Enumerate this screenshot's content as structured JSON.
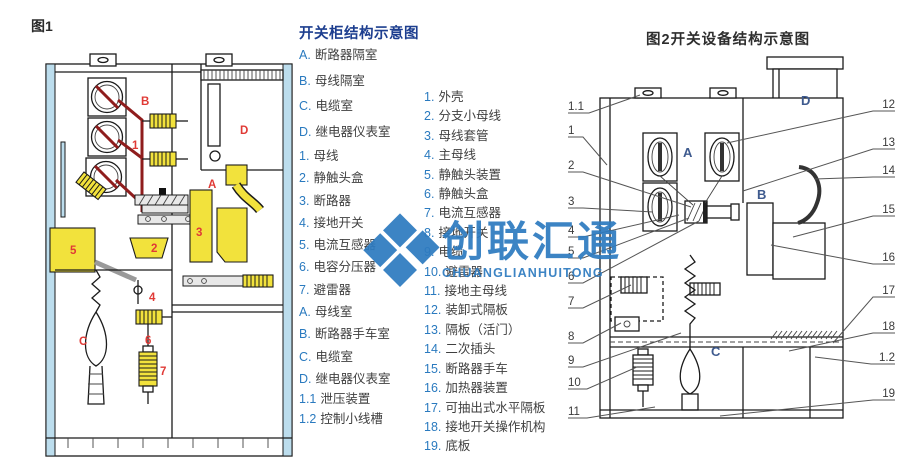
{
  "figure1": {
    "caption": "图1",
    "labels": [
      "B",
      "1",
      "D",
      "A",
      "5",
      "2",
      "3",
      "4",
      "C",
      "6",
      "7"
    ]
  },
  "center_legend": {
    "title": "开关柜结构示意图",
    "rooms1": [
      {
        "key": "A.",
        "label": "断路器隔室"
      },
      {
        "key": "B.",
        "label": "母线隔室"
      },
      {
        "key": "C.",
        "label": "电缆室"
      },
      {
        "key": "D.",
        "label": "继电器仪表室"
      }
    ],
    "parts": [
      {
        "key": "1.",
        "label": "母线"
      },
      {
        "key": "2.",
        "label": "静触头盒"
      },
      {
        "key": "3.",
        "label": "断路器"
      },
      {
        "key": "4.",
        "label": "接地开关"
      },
      {
        "key": "5.",
        "label": "电流互感器"
      },
      {
        "key": "6.",
        "label": "电容分压器"
      },
      {
        "key": "7.",
        "label": "避雷器"
      }
    ],
    "rooms2": [
      {
        "key": "A.",
        "label": "母线室"
      },
      {
        "key": "B.",
        "label": "断路器手车室"
      },
      {
        "key": "C.",
        "label": "电缆室"
      },
      {
        "key": "D.",
        "label": "继电器仪表室"
      }
    ],
    "extra": [
      {
        "key": "1.1",
        "label": "泄压装置"
      },
      {
        "key": "1.2",
        "label": "控制小线槽"
      }
    ]
  },
  "right_legend": {
    "items": [
      {
        "key": "1.",
        "label": "外壳"
      },
      {
        "key": "2.",
        "label": "分支小母线"
      },
      {
        "key": "3.",
        "label": "母线套管"
      },
      {
        "key": "4.",
        "label": "主母线"
      },
      {
        "key": "5.",
        "label": "静触头装置"
      },
      {
        "key": "6.",
        "label": "静触头盒"
      },
      {
        "key": "7.",
        "label": "电流互感器"
      },
      {
        "key": "8.",
        "label": "接地开关"
      },
      {
        "key": "9.",
        "label": "电缆"
      },
      {
        "key": "10.",
        "label": "避雷器"
      },
      {
        "key": "11.",
        "label": "接地主母线"
      },
      {
        "key": "12.",
        "label": "装卸式隔板"
      },
      {
        "key": "13.",
        "label": "隔板（活门）"
      },
      {
        "key": "14.",
        "label": "二次插头"
      },
      {
        "key": "15.",
        "label": "断路器手车"
      },
      {
        "key": "16.",
        "label": "加热器装置"
      },
      {
        "key": "17.",
        "label": "可抽出式水平隔板"
      },
      {
        "key": "18.",
        "label": "接地开关操作机构"
      },
      {
        "key": "19.",
        "label": "底板"
      }
    ]
  },
  "figure2": {
    "caption": "图2开关设备结构示意图",
    "callouts_left": [
      "1.1",
      "1",
      "2",
      "3",
      "4",
      "5",
      "6",
      "7",
      "8",
      "9",
      "10",
      "11"
    ],
    "callouts_right": [
      "12",
      "13",
      "14",
      "15",
      "16",
      "17",
      "18",
      "1.2",
      "19"
    ],
    "rooms": [
      "A",
      "B",
      "C",
      "D"
    ]
  },
  "watermark": {
    "cn": "创联汇通",
    "en": "CHUANGLIANHUITONG"
  },
  "colors": {
    "legend_title_blue": "#1d3e8f",
    "legend_key_blue": "#2a7abf",
    "figure1_label_red": "#e03a36",
    "figure1_component_yellow": "#f2e23c",
    "figure1_busbar_dark_red": "#8f1d1d",
    "figure1_panel_light_blue": "#bcdded",
    "figure2_room_label_blue": "#3e5a8e",
    "watermark_blue": "#2e7bc0"
  }
}
